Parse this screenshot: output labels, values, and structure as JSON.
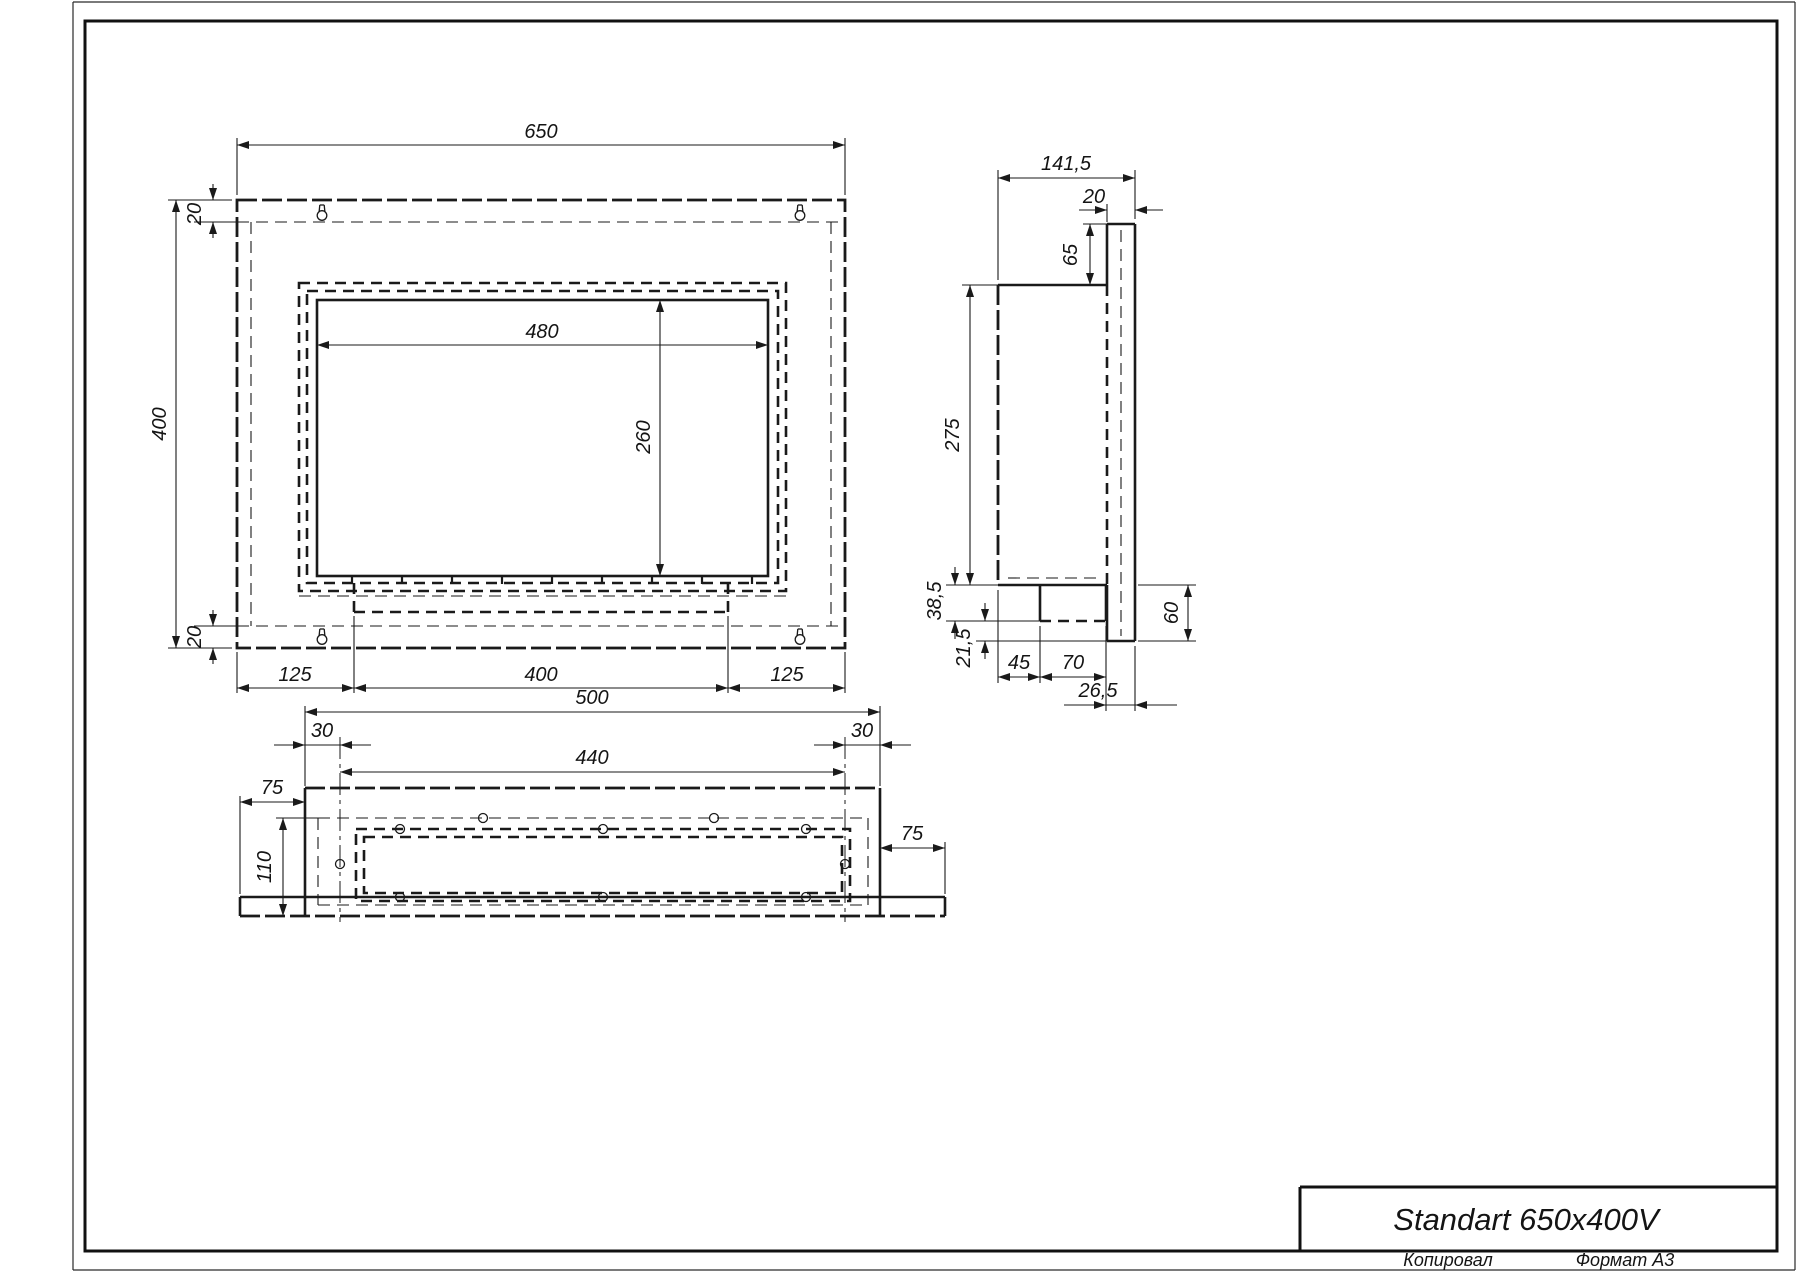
{
  "sheet": {
    "copied_label": "Копировал",
    "format_label": "Формат А3"
  },
  "title_block": {
    "model": "Standart 650x400V"
  },
  "front_view": {
    "dims": {
      "width": "650",
      "height": "400",
      "opening_width": "480",
      "opening_height": "260",
      "top_inset": "20",
      "bottom_inset": "20",
      "left_margin": "125",
      "tank_width": "400",
      "right_margin": "125"
    }
  },
  "side_view": {
    "dims": {
      "depth": "141,5",
      "plate_thickness": "20",
      "plate_above": "65",
      "body_height": "275",
      "tank_drop": "38,5",
      "tank_gap": "21,5",
      "tank_offset": "45",
      "tank_depth": "70",
      "tank_to_plate": "26,5",
      "plate_below": "60"
    }
  },
  "bottom_view": {
    "dims": {
      "body_width": "500",
      "hole_inset_left": "30",
      "hole_span": "440",
      "hole_inset_right": "30",
      "plate_overhang_left": "75",
      "opening_depth": "110",
      "plate_overhang_right": "75"
    }
  }
}
